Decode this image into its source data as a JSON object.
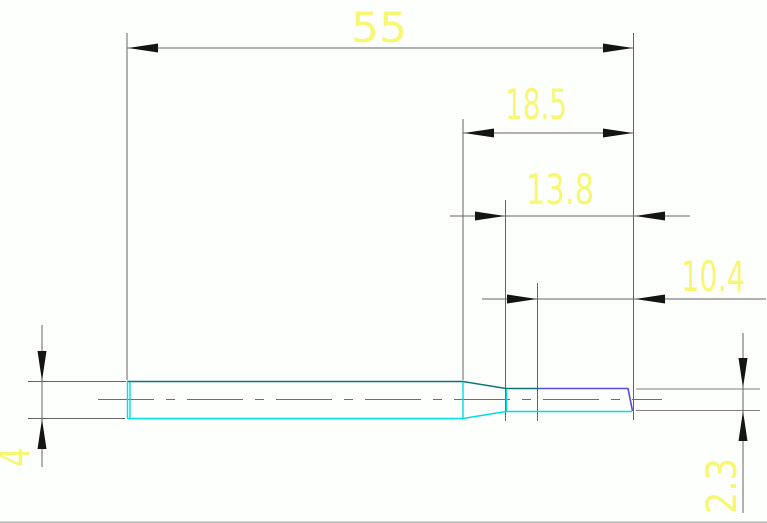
{
  "drawing": {
    "description": "technical drawing of stepped shaft",
    "dimensions": {
      "overall_length": "55",
      "step_to_end": "18.5",
      "small_section_length": "13.8",
      "blue_feature_length": "10.4",
      "large_diameter": "4",
      "small_diameter": "2.3"
    },
    "colors": {
      "dimension_text": "#f6f65a",
      "dimension_lines": "#636363",
      "arrows": "#141414",
      "outline_top": "#0d7474",
      "outline_bottom": "#00dfdf",
      "outline_blue_feature": "#574bdc",
      "centerline": "#6e6e6e",
      "background": "#ffffff"
    }
  }
}
